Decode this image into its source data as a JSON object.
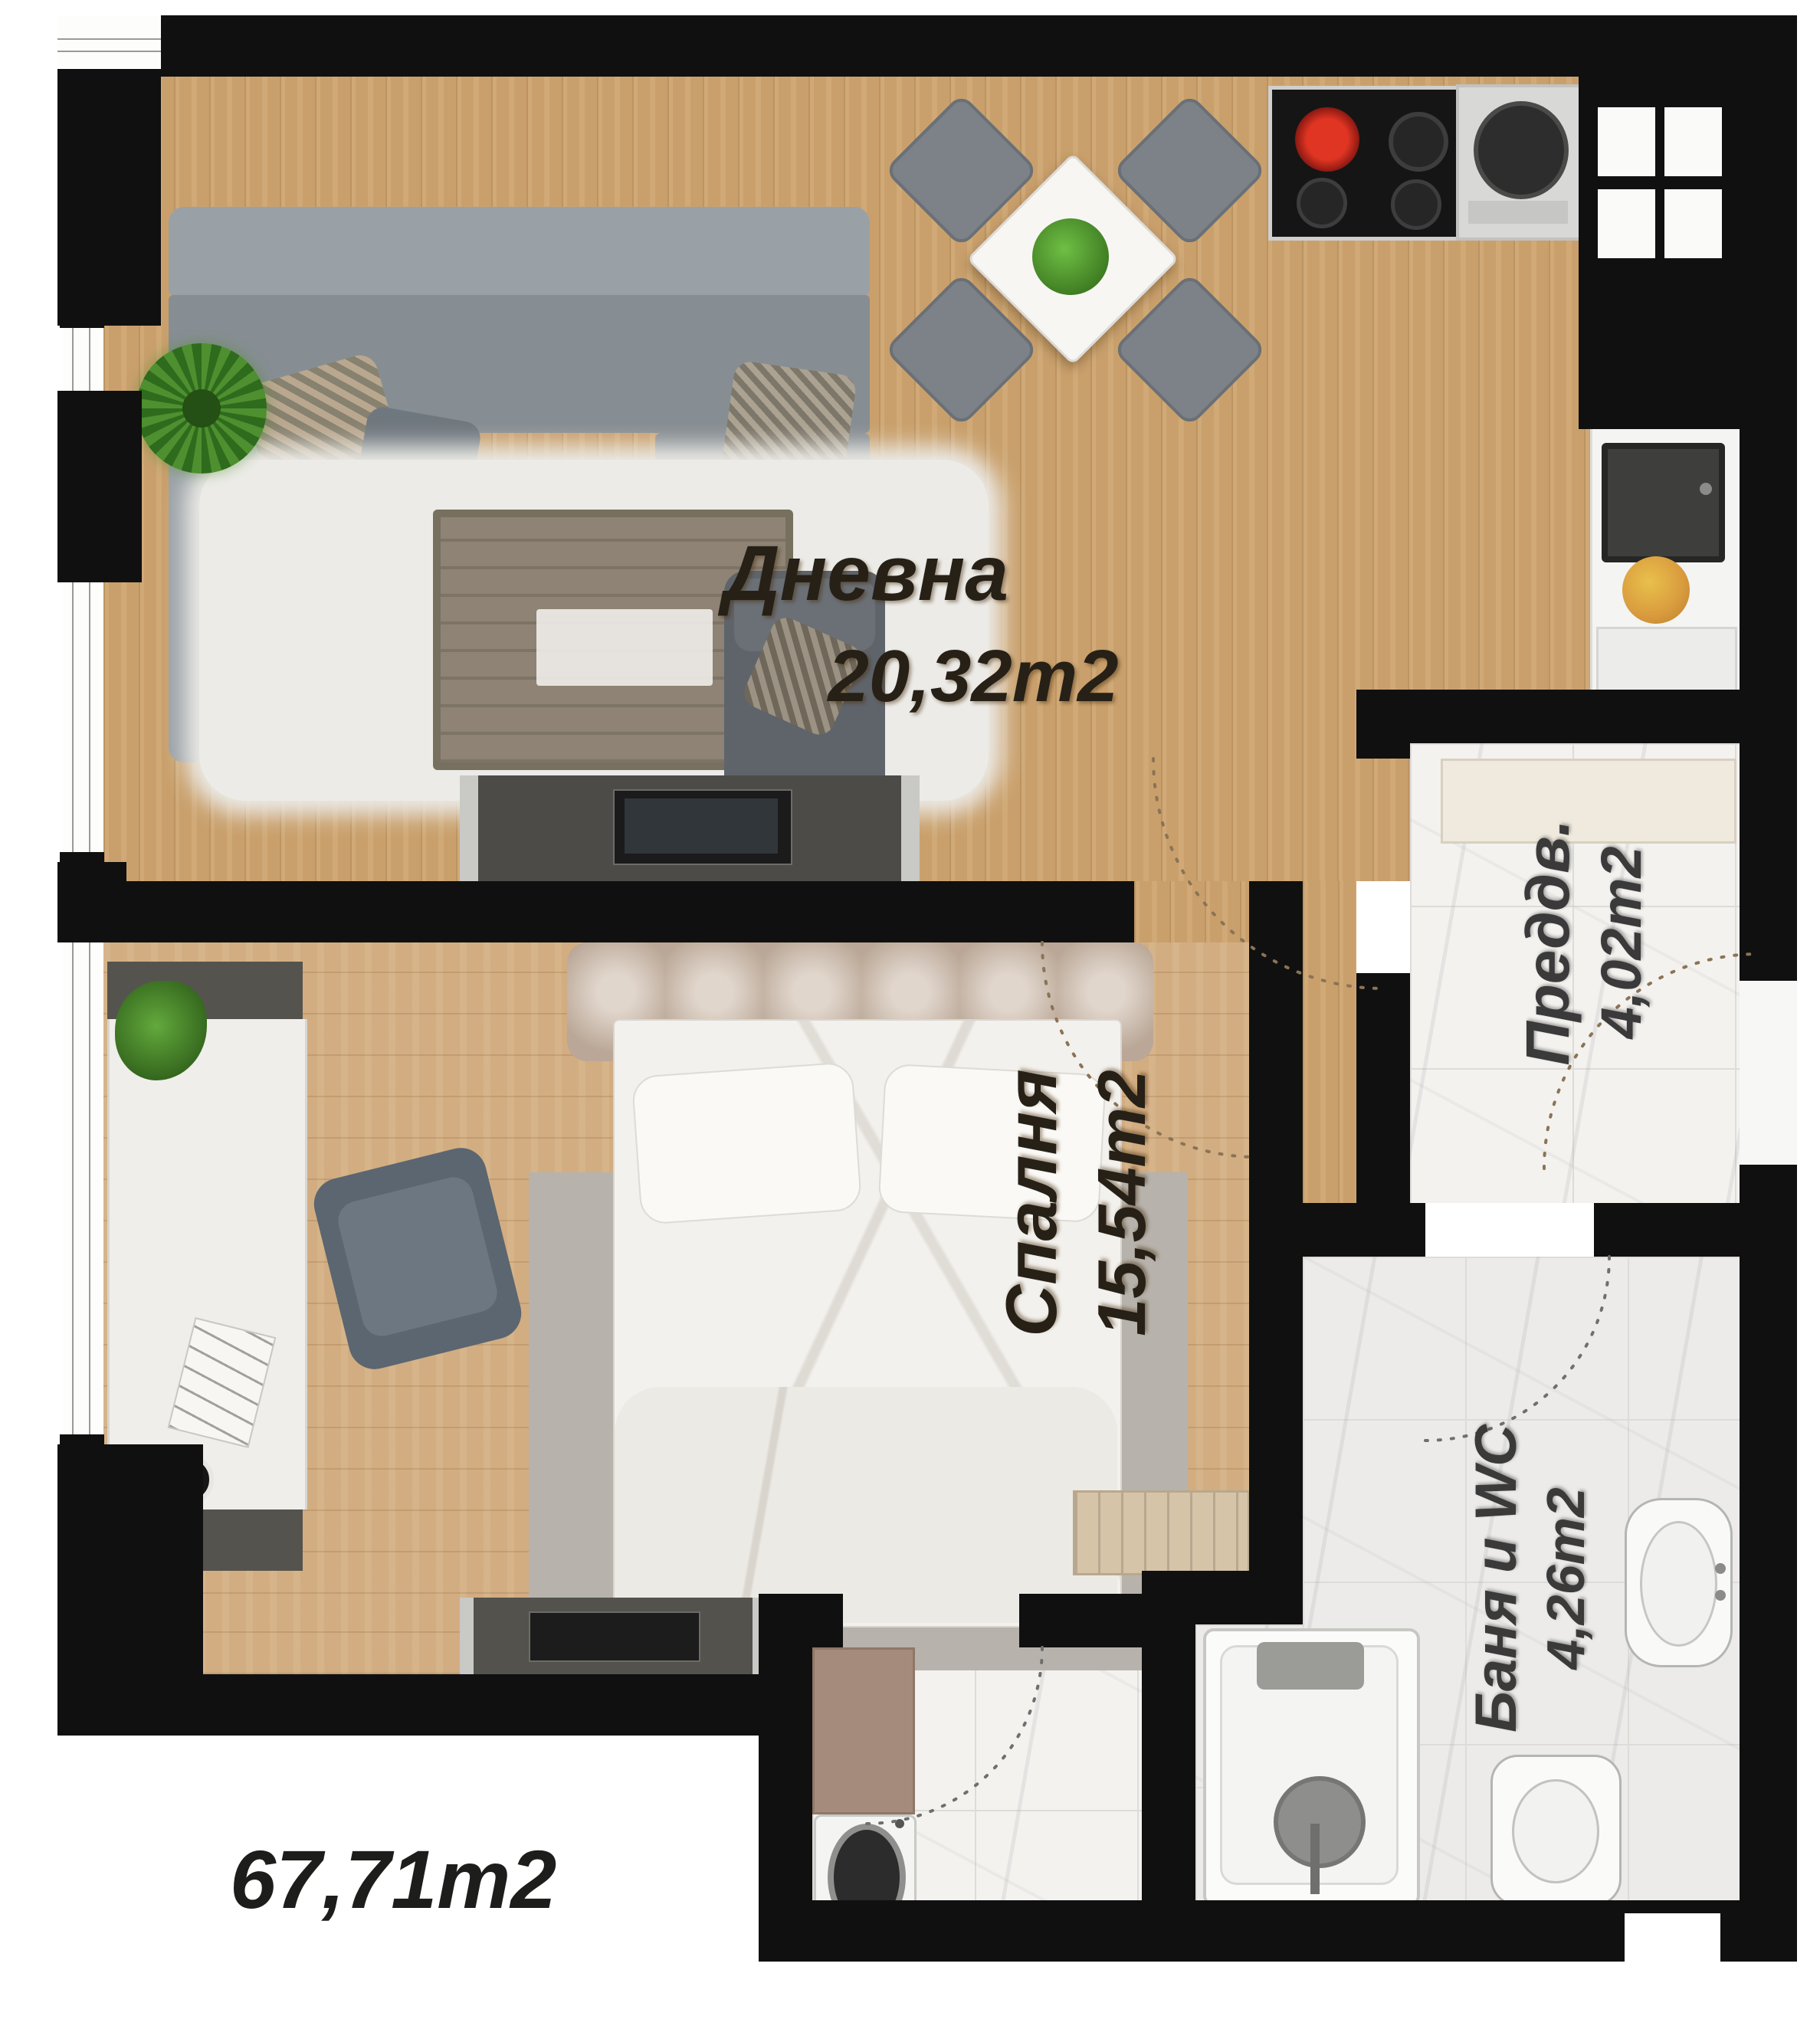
{
  "labels": {
    "living_name": "Дневна",
    "living_area": "20,32m2",
    "bedroom_name": "Спалня",
    "bedroom_area": "15,54m2",
    "hallway_name": "Преддв.",
    "hallway_area": "4,02m2",
    "bath_name": "Баня и WC",
    "bath_area": "4,26m2",
    "total_area": "67,71m2"
  },
  "palette": {
    "wall": "#101010",
    "wood_living": "#c9a06c",
    "wood_bedroom": "#d2ad82",
    "marble": "#f3f2ef",
    "plant_green": "#4e8f2f",
    "burner_red": "#e03522",
    "fruit_orange": "#d99b3e"
  }
}
